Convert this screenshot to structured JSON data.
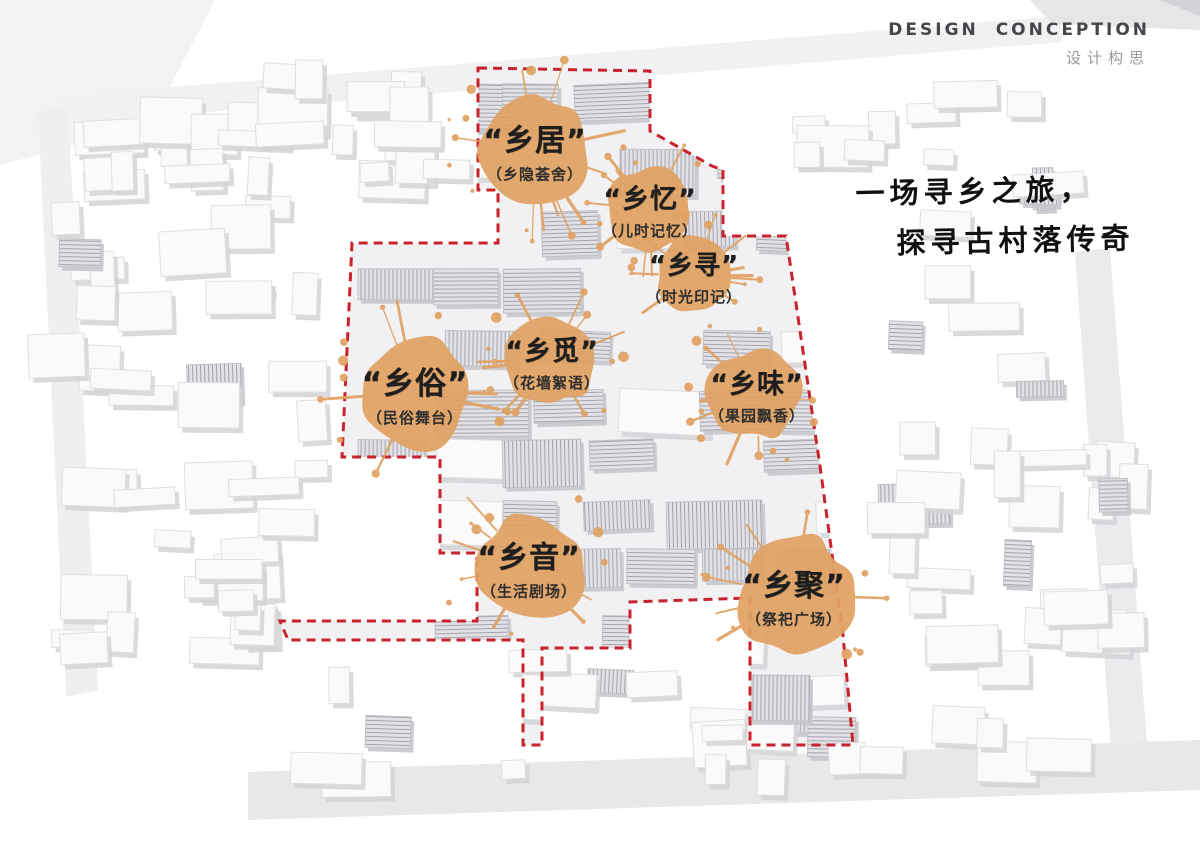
{
  "header": {
    "title": "DESIGN CONCEPTION",
    "subtitle": "设计构思"
  },
  "tagline": {
    "line1": "一场寻乡之旅，",
    "line2": "探寻古村落传奇"
  },
  "colors": {
    "splash": "#e1a161",
    "boundary": "#c8232c",
    "ink": "#1e1e1e"
  },
  "boundary": {
    "points": [
      [
        478,
        68
      ],
      [
        650,
        71
      ],
      [
        650,
        131
      ],
      [
        712,
        166
      ],
      [
        723,
        170
      ],
      [
        723,
        236
      ],
      [
        786,
        236
      ],
      [
        820,
        466
      ],
      [
        843,
        635
      ],
      [
        853,
        745
      ],
      [
        750,
        745
      ],
      [
        750,
        598
      ],
      [
        630,
        602
      ],
      [
        630,
        648
      ],
      [
        542,
        648
      ],
      [
        542,
        745
      ],
      [
        523,
        745
      ],
      [
        523,
        640
      ],
      [
        288,
        640
      ],
      [
        280,
        621
      ],
      [
        477,
        621
      ],
      [
        477,
        553
      ],
      [
        440,
        553
      ],
      [
        440,
        457
      ],
      [
        342,
        457
      ],
      [
        352,
        243
      ],
      [
        498,
        243
      ],
      [
        498,
        190
      ],
      [
        478,
        190
      ]
    ]
  },
  "markers": [
    {
      "label": "“乡居”",
      "subtitle": "（乡隐荟舍）",
      "x": 535,
      "y": 150,
      "r": 56,
      "size": 30
    },
    {
      "label": "“乡忆”",
      "subtitle": "（儿时记忆）",
      "x": 650,
      "y": 209,
      "r": 42,
      "size": 27
    },
    {
      "label": "“乡寻”",
      "subtitle": "（时光印记）",
      "x": 694,
      "y": 276,
      "r": 40,
      "size": 26
    },
    {
      "label": "“乡觅”",
      "subtitle": "（花墙絮语）",
      "x": 552,
      "y": 361,
      "r": 45,
      "size": 27
    },
    {
      "label": "“乡俗”",
      "subtitle": "（民俗舞台）",
      "x": 415,
      "y": 393,
      "r": 56,
      "size": 31
    },
    {
      "label": "“乡味”",
      "subtitle": "（果园飘香）",
      "x": 757,
      "y": 394,
      "r": 47,
      "size": 27
    },
    {
      "label": "“乡音”",
      "subtitle": "（生活剧场）",
      "x": 529,
      "y": 567,
      "r": 54,
      "size": 30
    },
    {
      "label": "“乡聚”",
      "subtitle": "（祭祀广场）",
      "x": 794,
      "y": 595,
      "r": 60,
      "size": 30
    }
  ]
}
